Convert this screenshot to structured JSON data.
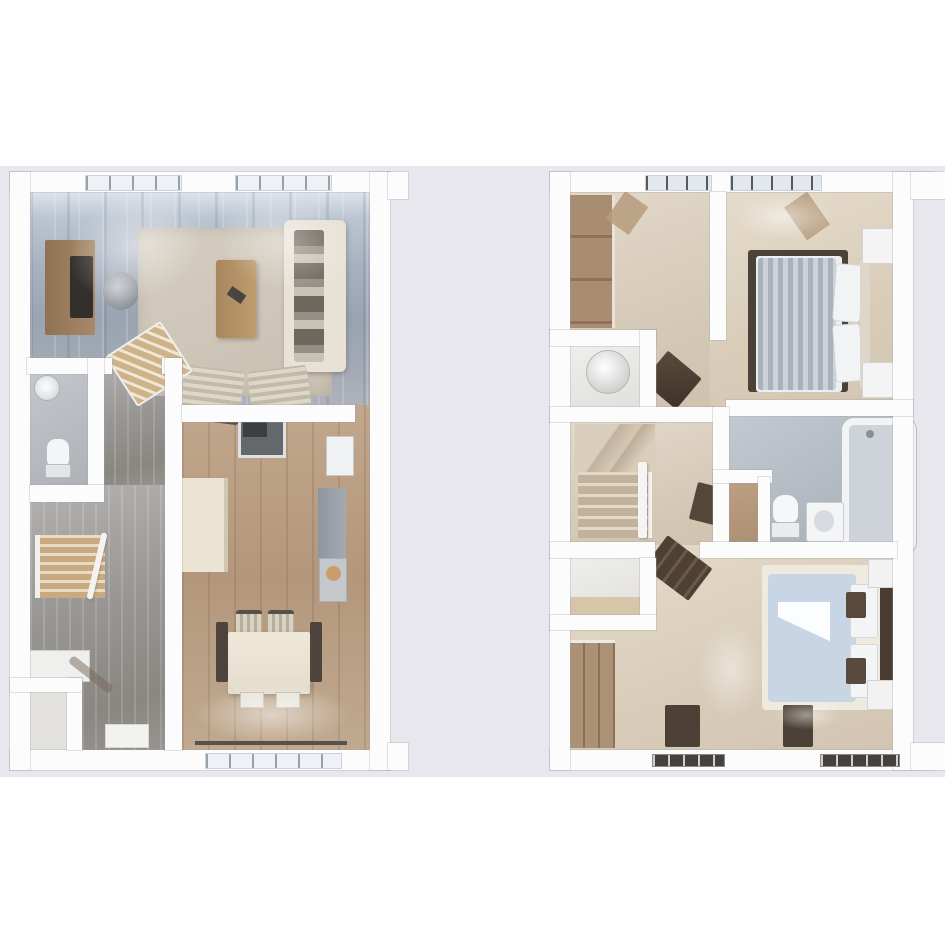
{
  "page": {
    "background": "#ffffff",
    "backdrop": "#e7e7ed",
    "aria_label": "Two 3D top-down floor plans shown side by side"
  },
  "palette": {
    "wall": "#fcfcfd",
    "wall_outline": "#9e9eaa",
    "living_floor_wood": "#a8b1bf",
    "hall_floor_wood": "#989694",
    "kitchen_floor_wood": "#b3977c",
    "carpet_beige": "#d9cdba",
    "bathroom_tile": "#b3bac1",
    "furniture_wood": "#a78c70",
    "dark_wood": "#4c3f33",
    "dark_rug": "#4b423a",
    "duvet_blue": "#c6d4e3",
    "duvet_grey_stripe": "#aab3bd",
    "window_glass": "#e8edf2",
    "sofa_cream": "#e8e2d6"
  },
  "ground_floor": {
    "aria_label": "Ground floor 3D plan",
    "rooms": [
      "living-room",
      "wc",
      "hallway",
      "staircase",
      "under-stairs-cupboard",
      "kitchen-diner"
    ],
    "furniture": [
      "tv-unit",
      "tv",
      "round-chair",
      "area-rug",
      "coffee-table",
      "sofa",
      "armchairs",
      "washbasin",
      "toilet",
      "stairs",
      "hall-bench",
      "door-mat",
      "cooker",
      "fridge",
      "worktop",
      "kitchen-cabinet",
      "dining-table",
      "dining-chairs"
    ]
  },
  "first_floor": {
    "aria_label": "First floor 3D plan",
    "rooms": [
      "landing",
      "airing-cupboard",
      "staircase",
      "inner-hall",
      "bathroom",
      "linen-cupboard",
      "bedroom-1",
      "bedroom-2",
      "built-in-closet"
    ],
    "furniture": [
      "wardrobe",
      "water-cylinder",
      "desk",
      "stairs",
      "shelf-unit",
      "bathtub",
      "toilet",
      "vanity-basin",
      "double-bed-grey",
      "double-bed-blue",
      "bedside-tables",
      "lamps",
      "dark-rug",
      "runner-rugs",
      "dresser",
      "roof-beams"
    ]
  }
}
